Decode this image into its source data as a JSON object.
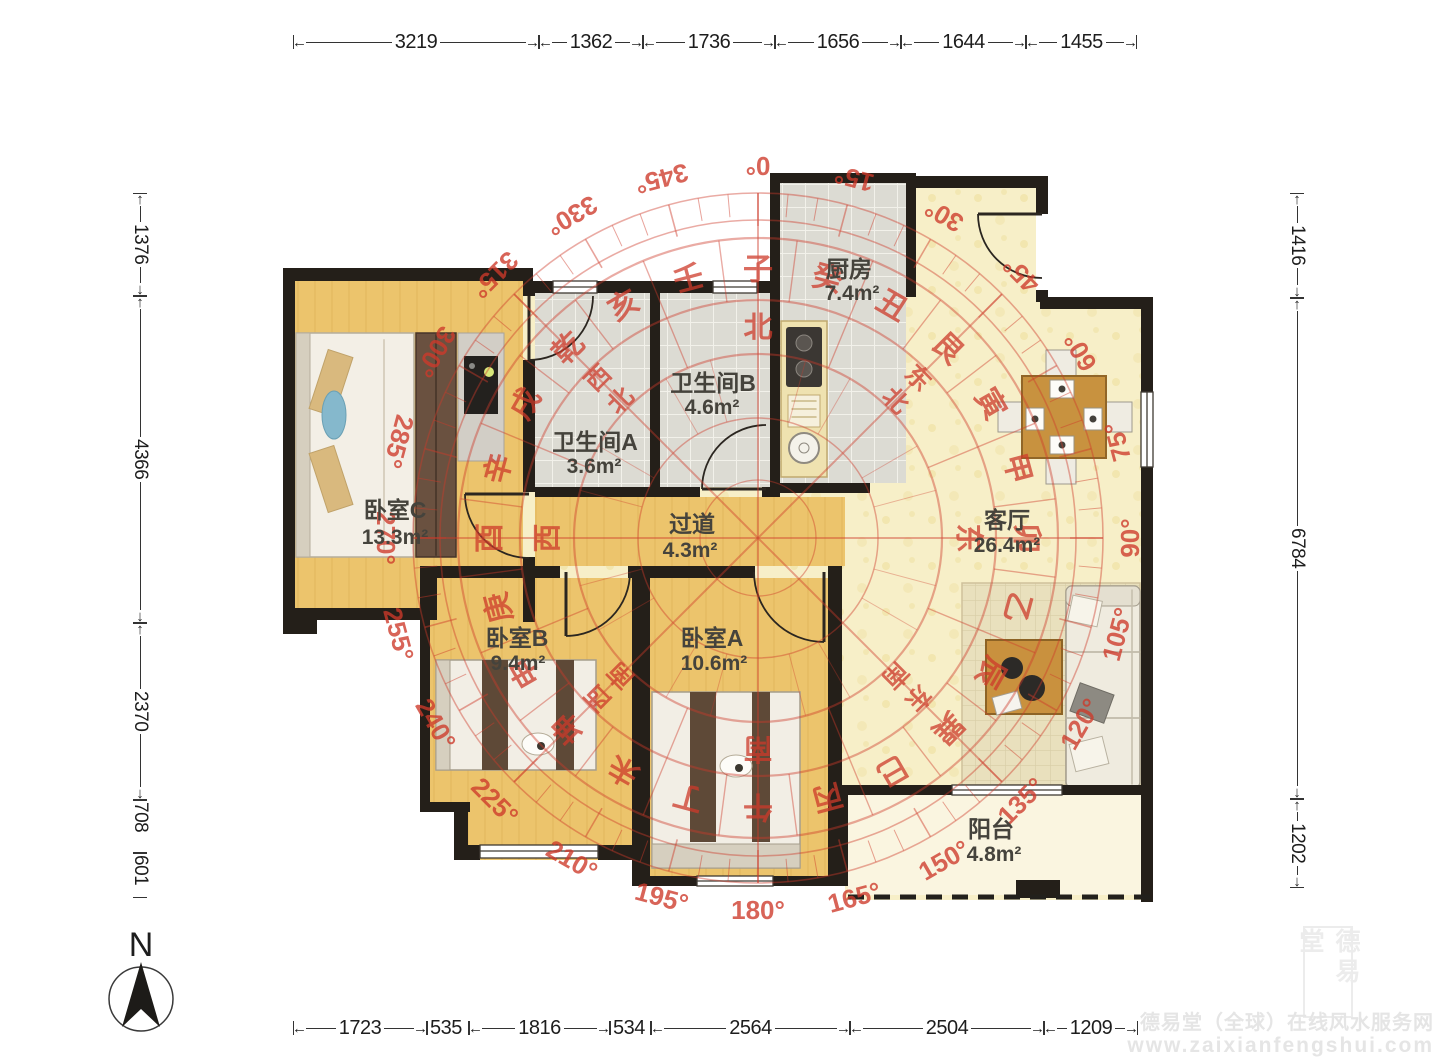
{
  "dimensions": {
    "top": [
      "3219",
      "1362",
      "1736",
      "1656",
      "1644",
      "1455"
    ],
    "bottom": [
      "1723",
      "535",
      "1816",
      "534",
      "2564",
      "2504",
      "1209"
    ],
    "left": [
      "1376",
      "4366",
      "2370",
      "708",
      "601"
    ],
    "right": [
      "1416",
      "6784",
      "1202"
    ]
  },
  "rooms": {
    "bedroomC": {
      "name": "卧室C",
      "area": "13.3m²"
    },
    "bathroomA": {
      "name": "卫生间A",
      "area": "3.6m²"
    },
    "bathroomB": {
      "name": "卫生间B",
      "area": "4.6m²"
    },
    "kitchen": {
      "name": "厨房",
      "area": "7.4m²"
    },
    "living": {
      "name": "客厅",
      "area": "26.4m²"
    },
    "hallway": {
      "name": "过道",
      "area": "4.3m²"
    },
    "bedroomB": {
      "name": "卧室B",
      "area": "9.4m²"
    },
    "bedroomA": {
      "name": "卧室A",
      "area": "10.6m²"
    },
    "balcony": {
      "name": "阳台",
      "area": "4.8m²"
    }
  },
  "compass": {
    "color": "#cd3a2a",
    "degree_step": 15,
    "degree_labels": [
      "0",
      "15",
      "30",
      "45",
      "60",
      "75",
      "90",
      "105",
      "120",
      "135",
      "150",
      "165",
      "180",
      "195",
      "210",
      "225",
      "240",
      "255",
      "270",
      "285",
      "300",
      "315",
      "330",
      "345"
    ],
    "mountains": [
      "子",
      "癸",
      "丑",
      "艮",
      "寅",
      "甲",
      "卯",
      "乙",
      "辰",
      "巽",
      "巳",
      "丙",
      "午",
      "丁",
      "未",
      "坤",
      "申",
      "庚",
      "酉",
      "辛",
      "戌",
      "乾",
      "亥",
      "壬"
    ],
    "directions": [
      "北",
      "东北",
      "东",
      "东南",
      "南",
      "西南",
      "西",
      "西北"
    ]
  },
  "north_indicator": {
    "label": "N"
  },
  "watermark": {
    "seal_text": "德易堂",
    "line1": "德易堂（全球）在线风水服务网",
    "line2": "www.zaixianfengshui.com"
  }
}
